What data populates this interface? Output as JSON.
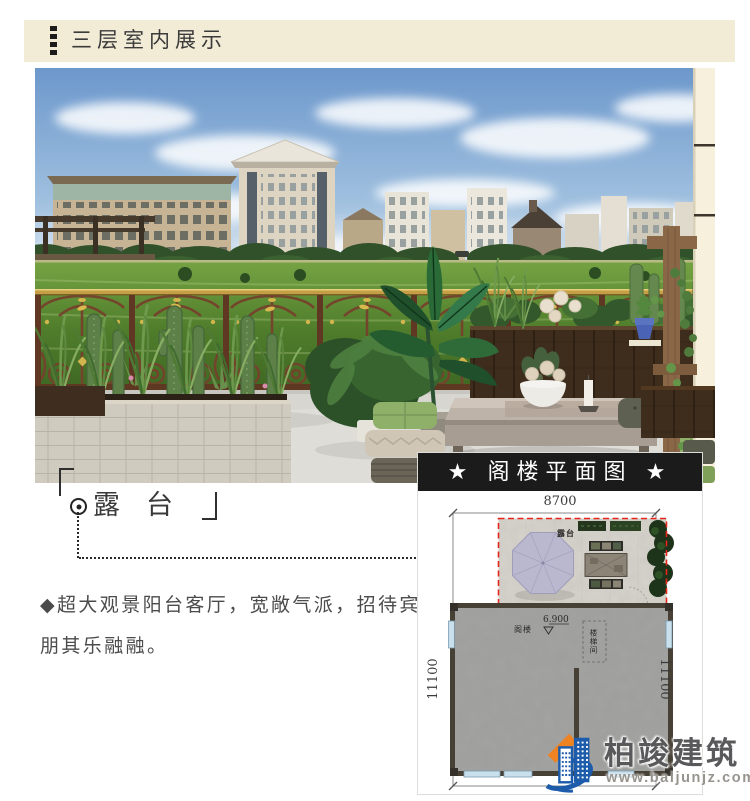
{
  "header": {
    "title": "三层室内展示"
  },
  "callout": {
    "label": "露台"
  },
  "description": {
    "text": "◆超大观景阳台客厅，宽敞气派，招待宾朋其乐融融。"
  },
  "floor_plan": {
    "title": "★ 阁楼平面图 ★",
    "dim_top": "8700",
    "dim_left": "11100",
    "dim_right": "11100",
    "labels": {
      "terrace": "露台",
      "attic": "阁楼",
      "elevation": "6.900",
      "stairwell": "楼梯间"
    }
  },
  "logo": {
    "company": "柏竣建筑",
    "website": "www.baijunjz.com"
  },
  "colors": {
    "header_bg": "#f2ebd5",
    "title_bar_bg": "#1b1b1b",
    "plan_accent_red": "#e4261c",
    "railing_brown": "#74422c",
    "railing_gold": "#d9b84e",
    "lawn_green": "#4f7d2b",
    "sky_blue": "#6d98cc",
    "umbrella_lavender": "#b9b8ce",
    "logo_blue": "#1c5cab",
    "logo_orange": "#ef8322"
  }
}
